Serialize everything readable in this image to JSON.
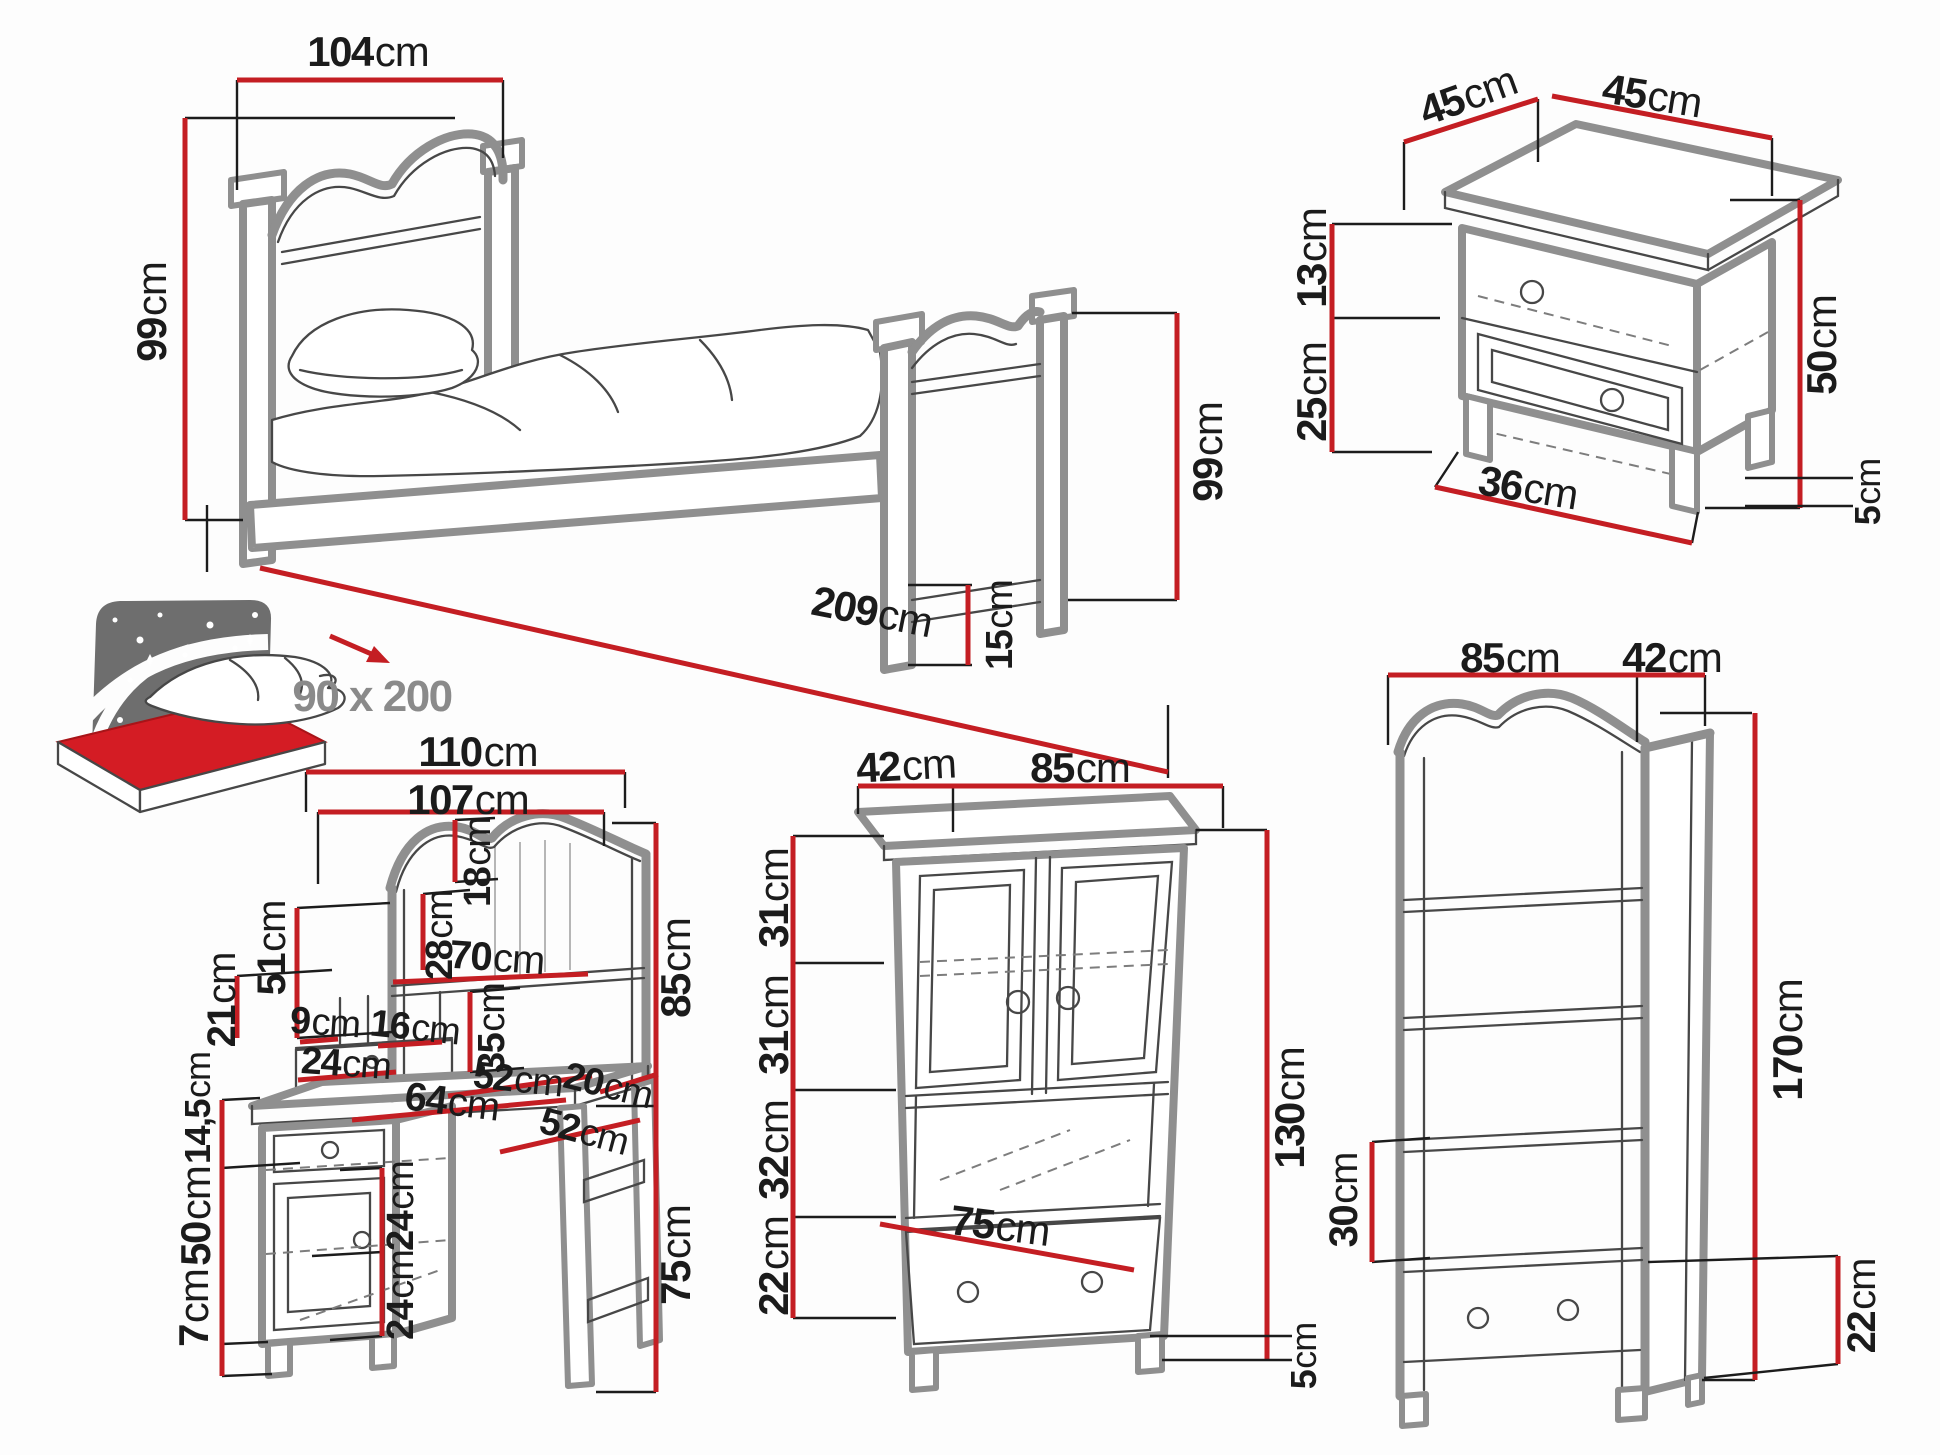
{
  "diagram": {
    "type": "furniture-dimension-diagram",
    "unit": "cm",
    "colors": {
      "dimension_line": "#c41e23",
      "drawing_outline": "#8f8f8f",
      "label_text": "#1b1b1b",
      "muted_text": "#8a8a8a"
    },
    "pieces": [
      {
        "id": "bed",
        "labels": [
          {
            "text": "104cm",
            "x": 368,
            "y": 52,
            "rot": 0,
            "size": 42
          },
          {
            "text": "99cm",
            "x": 152,
            "y": 312,
            "rot": -90,
            "size": 42
          },
          {
            "text": "99cm",
            "x": 1208,
            "y": 452,
            "rot": -90,
            "size": 42
          },
          {
            "text": "209cm",
            "x": 872,
            "y": 612,
            "rot": 11,
            "size": 42
          },
          {
            "text": "15cm",
            "x": 1000,
            "y": 625,
            "rot": -90,
            "size": 38
          },
          {
            "text": "90 x 200",
            "x": 372,
            "y": 697,
            "rot": 0,
            "size": 44,
            "muted": true
          }
        ]
      },
      {
        "id": "nightstand",
        "labels": [
          {
            "text": "45cm",
            "x": 1468,
            "y": 96,
            "rot": -20,
            "size": 42
          },
          {
            "text": "45cm",
            "x": 1652,
            "y": 96,
            "rot": 9,
            "size": 42
          },
          {
            "text": "13cm",
            "x": 1312,
            "y": 258,
            "rot": -90,
            "size": 42
          },
          {
            "text": "25cm",
            "x": 1312,
            "y": 392,
            "rot": -90,
            "size": 42
          },
          {
            "text": "50cm",
            "x": 1822,
            "y": 345,
            "rot": -90,
            "size": 42
          },
          {
            "text": "36cm",
            "x": 1528,
            "y": 488,
            "rot": 9,
            "size": 42
          },
          {
            "text": "5cm",
            "x": 1868,
            "y": 492,
            "rot": -90,
            "size": 36
          }
        ]
      },
      {
        "id": "desk",
        "labels": [
          {
            "text": "110cm",
            "x": 478,
            "y": 752,
            "rot": 0,
            "size": 42
          },
          {
            "text": "107cm",
            "x": 468,
            "y": 800,
            "rot": 0,
            "size": 42
          },
          {
            "text": "18cm",
            "x": 478,
            "y": 862,
            "rot": -90,
            "size": 38
          },
          {
            "text": "28cm",
            "x": 440,
            "y": 935,
            "rot": -90,
            "size": 38
          },
          {
            "text": "70cm",
            "x": 497,
            "y": 958,
            "rot": 4,
            "size": 40
          },
          {
            "text": "51cm",
            "x": 272,
            "y": 948,
            "rot": -90,
            "size": 40
          },
          {
            "text": "21cm",
            "x": 222,
            "y": 1000,
            "rot": -90,
            "size": 40
          },
          {
            "text": "9cm",
            "x": 325,
            "y": 1023,
            "rot": 4,
            "size": 38
          },
          {
            "text": "16cm",
            "x": 415,
            "y": 1028,
            "rot": 6,
            "size": 38
          },
          {
            "text": "35cm",
            "x": 492,
            "y": 1028,
            "rot": -90,
            "size": 38
          },
          {
            "text": "24cm",
            "x": 346,
            "y": 1064,
            "rot": 4,
            "size": 38
          },
          {
            "text": "52cm",
            "x": 518,
            "y": 1080,
            "rot": 6,
            "size": 38
          },
          {
            "text": "64cm",
            "x": 452,
            "y": 1102,
            "rot": 7,
            "size": 40
          },
          {
            "text": "20cm",
            "x": 608,
            "y": 1086,
            "rot": 14,
            "size": 38
          },
          {
            "text": "52cm",
            "x": 584,
            "y": 1132,
            "rot": 15,
            "size": 38
          },
          {
            "text": "85cm",
            "x": 676,
            "y": 968,
            "rot": -90,
            "size": 42
          },
          {
            "text": "75cm",
            "x": 676,
            "y": 1255,
            "rot": -90,
            "size": 42
          },
          {
            "text": "14,5cm",
            "x": 198,
            "y": 1108,
            "rot": -90,
            "size": 36
          },
          {
            "text": "50cm",
            "x": 196,
            "y": 1216,
            "rot": -90,
            "size": 42
          },
          {
            "text": "7cm",
            "x": 194,
            "y": 1308,
            "rot": -90,
            "size": 42
          },
          {
            "text": "24cm",
            "x": 401,
            "y": 1206,
            "rot": -90,
            "size": 38
          },
          {
            "text": "24cm",
            "x": 401,
            "y": 1295,
            "rot": -90,
            "size": 38
          }
        ]
      },
      {
        "id": "cabinet",
        "labels": [
          {
            "text": "42cm",
            "x": 906,
            "y": 766,
            "rot": -3,
            "size": 42
          },
          {
            "text": "85cm",
            "x": 1080,
            "y": 768,
            "rot": 0,
            "size": 42
          },
          {
            "text": "31cm",
            "x": 774,
            "y": 898,
            "rot": -90,
            "size": 42
          },
          {
            "text": "31cm",
            "x": 774,
            "y": 1025,
            "rot": -90,
            "size": 42
          },
          {
            "text": "32cm",
            "x": 774,
            "y": 1150,
            "rot": -90,
            "size": 42
          },
          {
            "text": "22cm",
            "x": 774,
            "y": 1266,
            "rot": -90,
            "size": 42
          },
          {
            "text": "130cm",
            "x": 1290,
            "y": 1108,
            "rot": -90,
            "size": 42
          },
          {
            "text": "75cm",
            "x": 1000,
            "y": 1226,
            "rot": 7,
            "size": 42
          },
          {
            "text": "5cm",
            "x": 1304,
            "y": 1356,
            "rot": -90,
            "size": 36
          }
        ]
      },
      {
        "id": "bookcase",
        "labels": [
          {
            "text": "85cm",
            "x": 1510,
            "y": 658,
            "rot": 0,
            "size": 42
          },
          {
            "text": "42cm",
            "x": 1672,
            "y": 658,
            "rot": 0,
            "size": 42
          },
          {
            "text": "170cm",
            "x": 1788,
            "y": 1040,
            "rot": -90,
            "size": 42
          },
          {
            "text": "30cm",
            "x": 1344,
            "y": 1200,
            "rot": -90,
            "size": 40
          },
          {
            "text": "22cm",
            "x": 1862,
            "y": 1306,
            "rot": -90,
            "size": 40
          }
        ]
      }
    ]
  }
}
